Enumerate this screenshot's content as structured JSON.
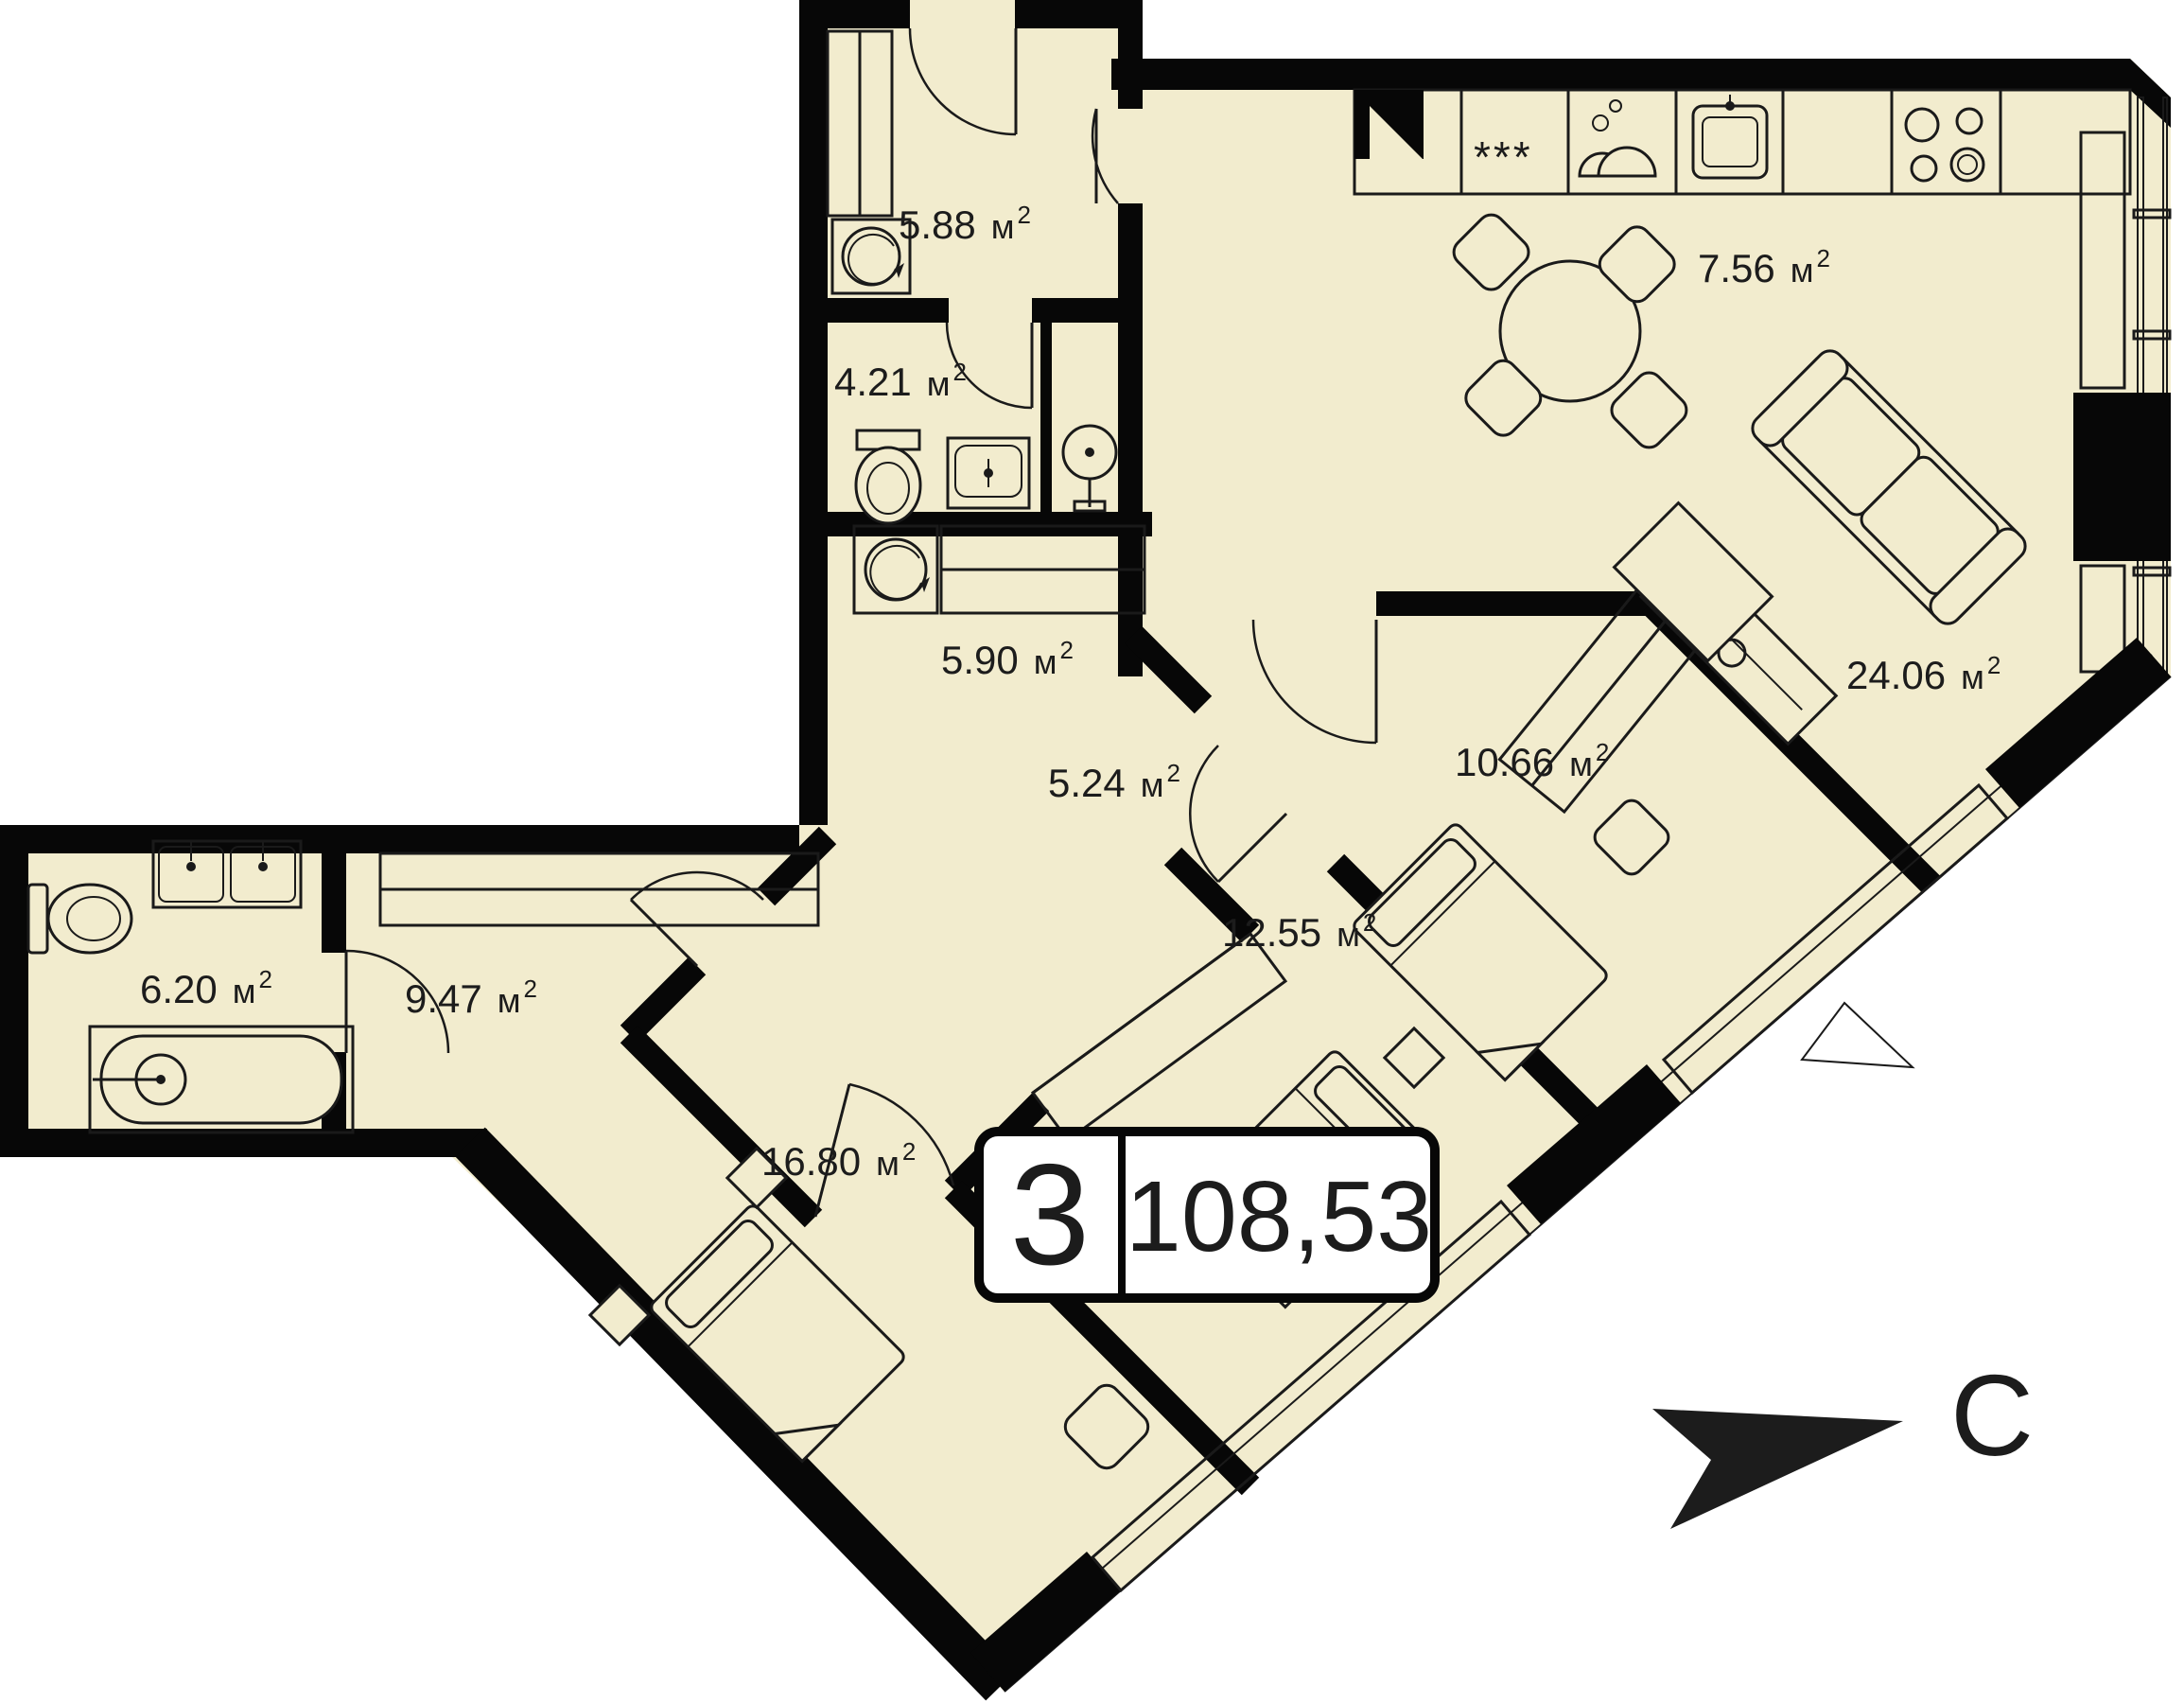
{
  "plan": {
    "north_label": "С",
    "unit": {
      "m": "м",
      "sup": "2"
    },
    "badge": {
      "rooms_count": "3",
      "total_area": "108,53"
    },
    "kitchen_icons": {
      "freezer_stars": "***"
    },
    "colors": {
      "floor": "#f2ecce",
      "wall": "#070707",
      "line": "#1a1a1a",
      "bg": "#ffffff",
      "badge_bg": "#ffffff"
    },
    "rooms": {
      "entry": {
        "name": "entry-hall",
        "area": "5.88"
      },
      "wc": {
        "name": "wc-shower",
        "area": "4.21"
      },
      "kitchen": {
        "name": "kitchen-dining",
        "area": "7.56"
      },
      "laundry": {
        "name": "laundry-corridor",
        "area": "5.90"
      },
      "hall": {
        "name": "inner-hall",
        "area": "5.24"
      },
      "living": {
        "name": "living-room",
        "area": "24.06"
      },
      "bedroom1": {
        "name": "bedroom-right",
        "area": "10.66"
      },
      "bedroom2": {
        "name": "bedroom-middle",
        "area": "12.55"
      },
      "bath": {
        "name": "bathroom",
        "area": "6.20"
      },
      "corridor": {
        "name": "corridor-left",
        "area": "9.47"
      },
      "master": {
        "name": "master-bedroom",
        "area": "16.80"
      }
    }
  }
}
